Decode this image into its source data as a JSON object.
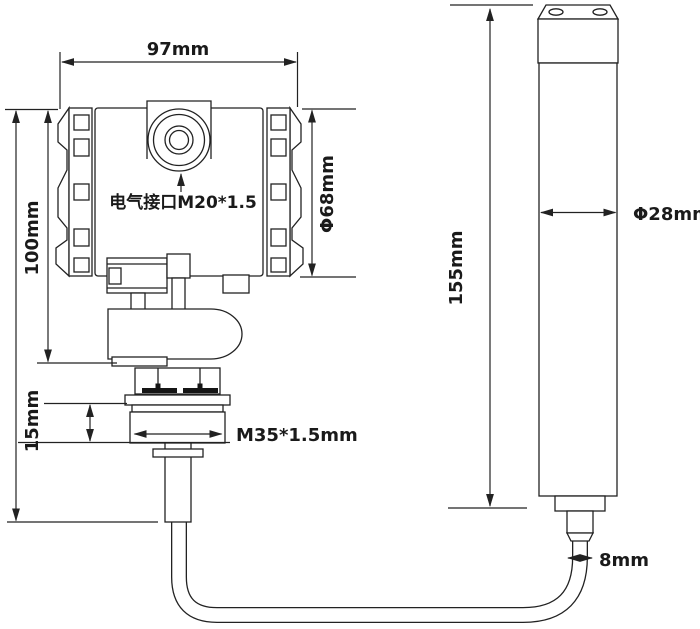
{
  "diagram": {
    "title_hint": "pressure level transmitter dimension drawing",
    "colors": {
      "line": "#222222",
      "background": "#ffffff",
      "text": "#1a1a1a"
    },
    "labels": {
      "housing_width": "97mm",
      "housing_height": "100mm",
      "housing_diameter": "Φ68mm",
      "electrical_port": "电气接口M20*1.5",
      "flange_height": "15mm",
      "thread_spec": "M35*1.5mm",
      "probe_length": "155mm",
      "probe_diameter": "Φ28mm",
      "cable_diameter": "8mm"
    }
  }
}
